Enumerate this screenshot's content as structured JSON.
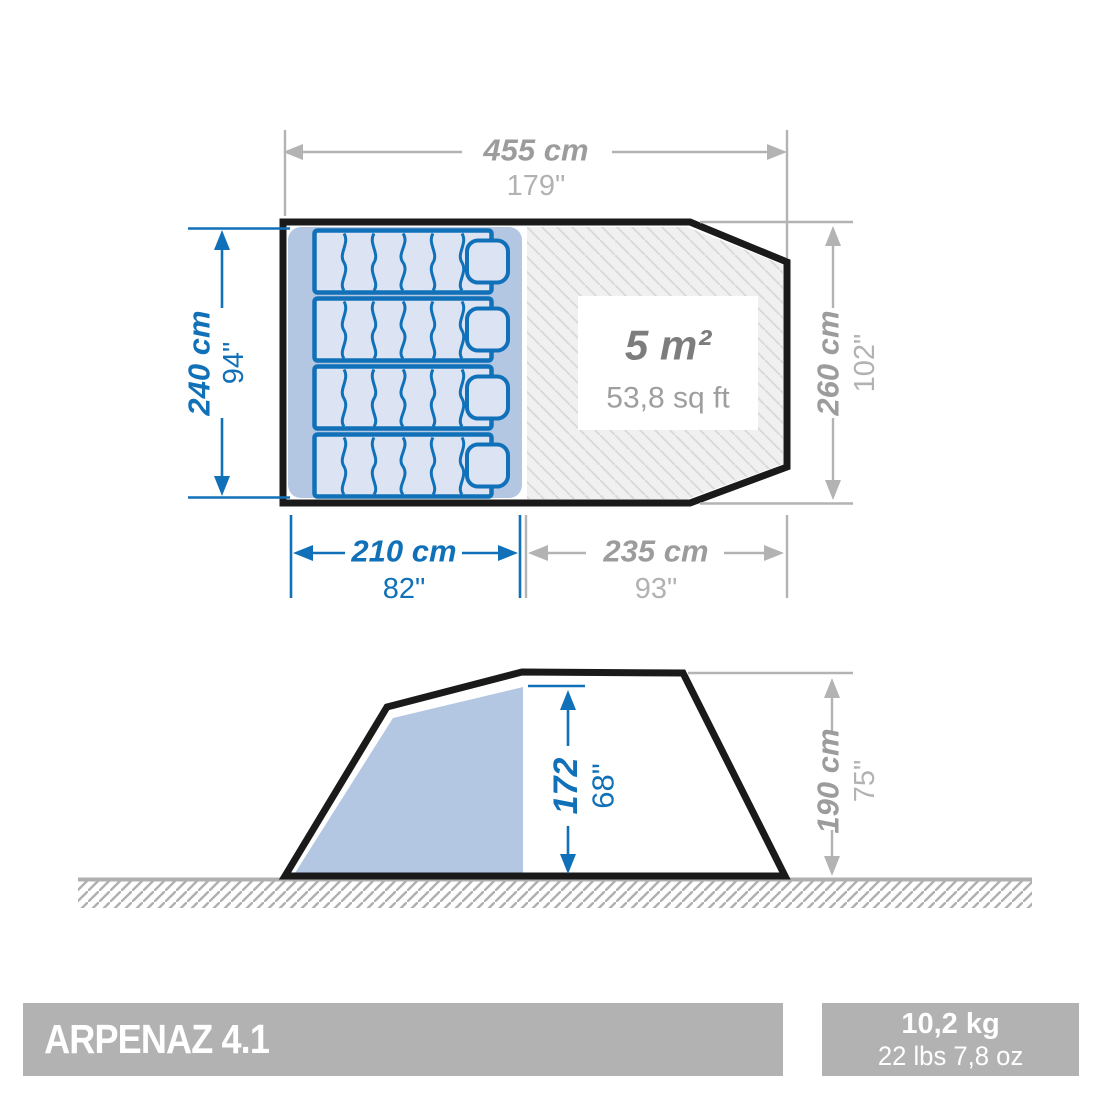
{
  "plan": {
    "width_cm": "455 cm",
    "width_in": "179\"",
    "depth_cm": "240 cm",
    "depth_in": "94\"",
    "right_cm": "260 cm",
    "right_in": "102\"",
    "bedroom_cm": "210 cm",
    "bedroom_in": "82\"",
    "living_cm": "235 cm",
    "living_in": "93\"",
    "area_m2": "5 m²",
    "area_sqft": "53,8 sq ft"
  },
  "side": {
    "inner_height_cm": "172",
    "inner_height_in": "68\"",
    "total_height_cm": "190 cm",
    "total_height_in": "75\""
  },
  "footer": {
    "model": "ARPENAZ 4.1",
    "weight_kg": "10,2 kg",
    "weight_imperial": "22 lbs 7,8 oz"
  },
  "colors": {
    "dimension_blue": "#1171b8",
    "dimension_gray": "#b3b3b3",
    "text_gray_bold": "#9c9c9c",
    "text_gray_secondary": "#b2b2b2",
    "bedroom_fill": "#b3c7e3",
    "mattress_fill": "#dce4f4",
    "hatch_fill": "#f0f0f0",
    "hatch_line": "#d8d8d8",
    "outline_black": "#1a1a1a",
    "footer_gray": "#b2b2b2"
  }
}
